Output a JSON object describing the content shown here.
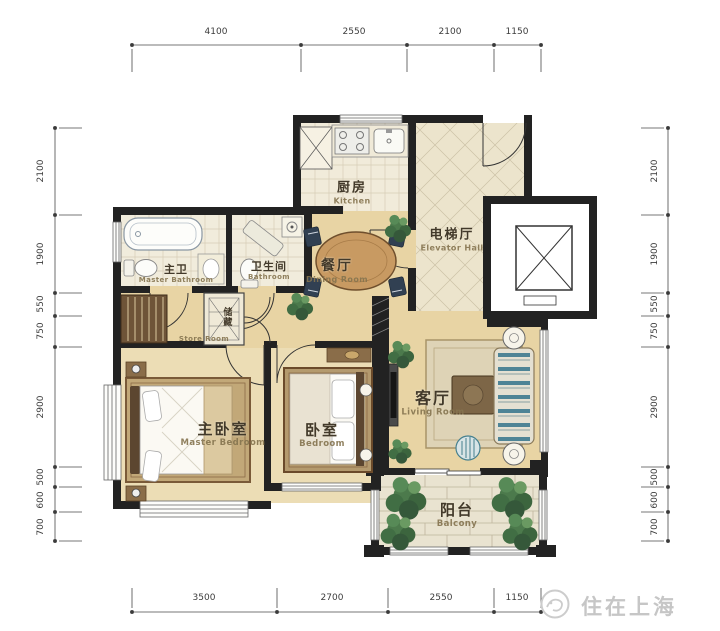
{
  "meta": {
    "watermark": "住在上海"
  },
  "rooms": {
    "kitchen": {
      "zh": "厨房",
      "en": "Kitchen"
    },
    "elevator_hall": {
      "zh": "电梯厅",
      "en": "Elevator Hall"
    },
    "dining": {
      "zh": "餐厅",
      "en": "Dining Room"
    },
    "master_bath": {
      "zh": "主卫",
      "en": "Master Bathroom"
    },
    "bathroom": {
      "zh": "卫生间",
      "en": "Bathroom"
    },
    "storage": {
      "zh": "储藏",
      "en": "Store Room"
    },
    "master_bedroom": {
      "zh": "主卧室",
      "en": "Master Bedroom"
    },
    "bedroom": {
      "zh": "卧室",
      "en": "Bedroom"
    },
    "living": {
      "zh": "客厅",
      "en": "Living Room"
    },
    "balcony": {
      "zh": "阳台",
      "en": "Balcony"
    }
  },
  "dimensions": {
    "top": [
      "4100",
      "2550",
      "2100",
      "1150"
    ],
    "bottom": [
      "3500",
      "2700",
      "2550",
      "1150"
    ],
    "left": [
      "2100",
      "1900",
      "550",
      "750",
      "2900",
      "500",
      "600",
      "700"
    ],
    "right": [
      "2100",
      "1900",
      "550",
      "750",
      "2900",
      "500",
      "600",
      "700"
    ]
  },
  "colors": {
    "wall": "#222222",
    "wood_floor": "#e8d4a4",
    "tile_floor": "#f1ebda",
    "hall_tile": "#ece4cc",
    "sofa_teal": "#4e8496",
    "plant_green": "#4c7a4c",
    "rug": "#ded3b6",
    "watermark_gray": "#c6c6c6"
  }
}
